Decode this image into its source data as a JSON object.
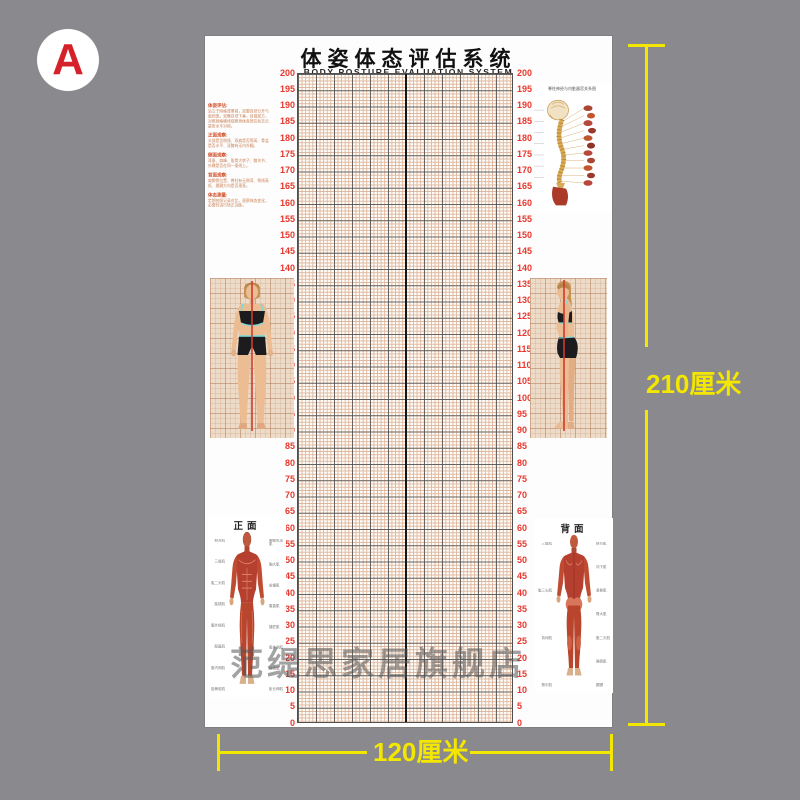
{
  "page": {
    "background": "#8a898d"
  },
  "badge": {
    "letter": "A"
  },
  "poster": {
    "title": "体姿体态评估系统",
    "subtitle": "BODY POSTURE EVALUATION SYSTEM",
    "scale": {
      "min": 0,
      "max": 200,
      "step": 5,
      "unit": "cm"
    },
    "info_sections": [
      {
        "heading": "体姿评估:",
        "body": "站立于网格背景前，双脚自然分开与肩同宽，双臂自然下垂，目视前方，对照网格横线观察身体各部位标志点是否水平对称。"
      },
      {
        "heading": "正面观察:",
        "body": "头部是否侧倾、双肩是否等高、骨盆是否水平、双膝有无内外翻。"
      },
      {
        "heading": "侧面观察:",
        "body": "耳垂、肩峰、股骨大转子、膝关节、外踝是否在同一垂线上。"
      },
      {
        "heading": "背面观察:",
        "body": "肩胛骨位置、脊柱有无侧弯、臀线高低、跟腱方向是否垂直。"
      },
      {
        "heading": "体态测量:",
        "body": "定期拍照记录对比，观察体态变化，必要时进行矫正训练。"
      }
    ],
    "spine_panel": {
      "title": "脊柱神经与内脏器官关系图"
    },
    "front_muscle": {
      "label": "正面",
      "left_labels": [
        "斜方肌",
        "三角肌",
        "肱二头肌",
        "肱桡肌",
        "腹外斜肌",
        "股直肌",
        "股内侧肌",
        "胫骨前肌"
      ],
      "right_labels": [
        "胸锁乳突肌",
        "胸大肌",
        "前锯肌",
        "腹直肌",
        "缝匠肌",
        "股外侧肌",
        "腓肠肌",
        "趾长伸肌"
      ]
    },
    "back_muscle": {
      "label": "背面",
      "left_labels": [
        "三角肌",
        "肱三头肌",
        "背阔肌",
        "臀中肌"
      ],
      "right_labels": [
        "斜方肌",
        "冈下肌",
        "竖脊肌",
        "臀大肌",
        "股二头肌",
        "腓肠肌",
        "跟腱"
      ]
    }
  },
  "annotations": {
    "height_label": "210厘米",
    "width_label": "120厘米"
  },
  "watermark": {
    "text": "范缇思家居旗舰店"
  },
  "colors": {
    "accent_yellow": "#f3e600",
    "scale_number_red": "#e8372c",
    "badge_letter_red": "#d6212b",
    "grid_fine_line": "#ddb69c"
  }
}
